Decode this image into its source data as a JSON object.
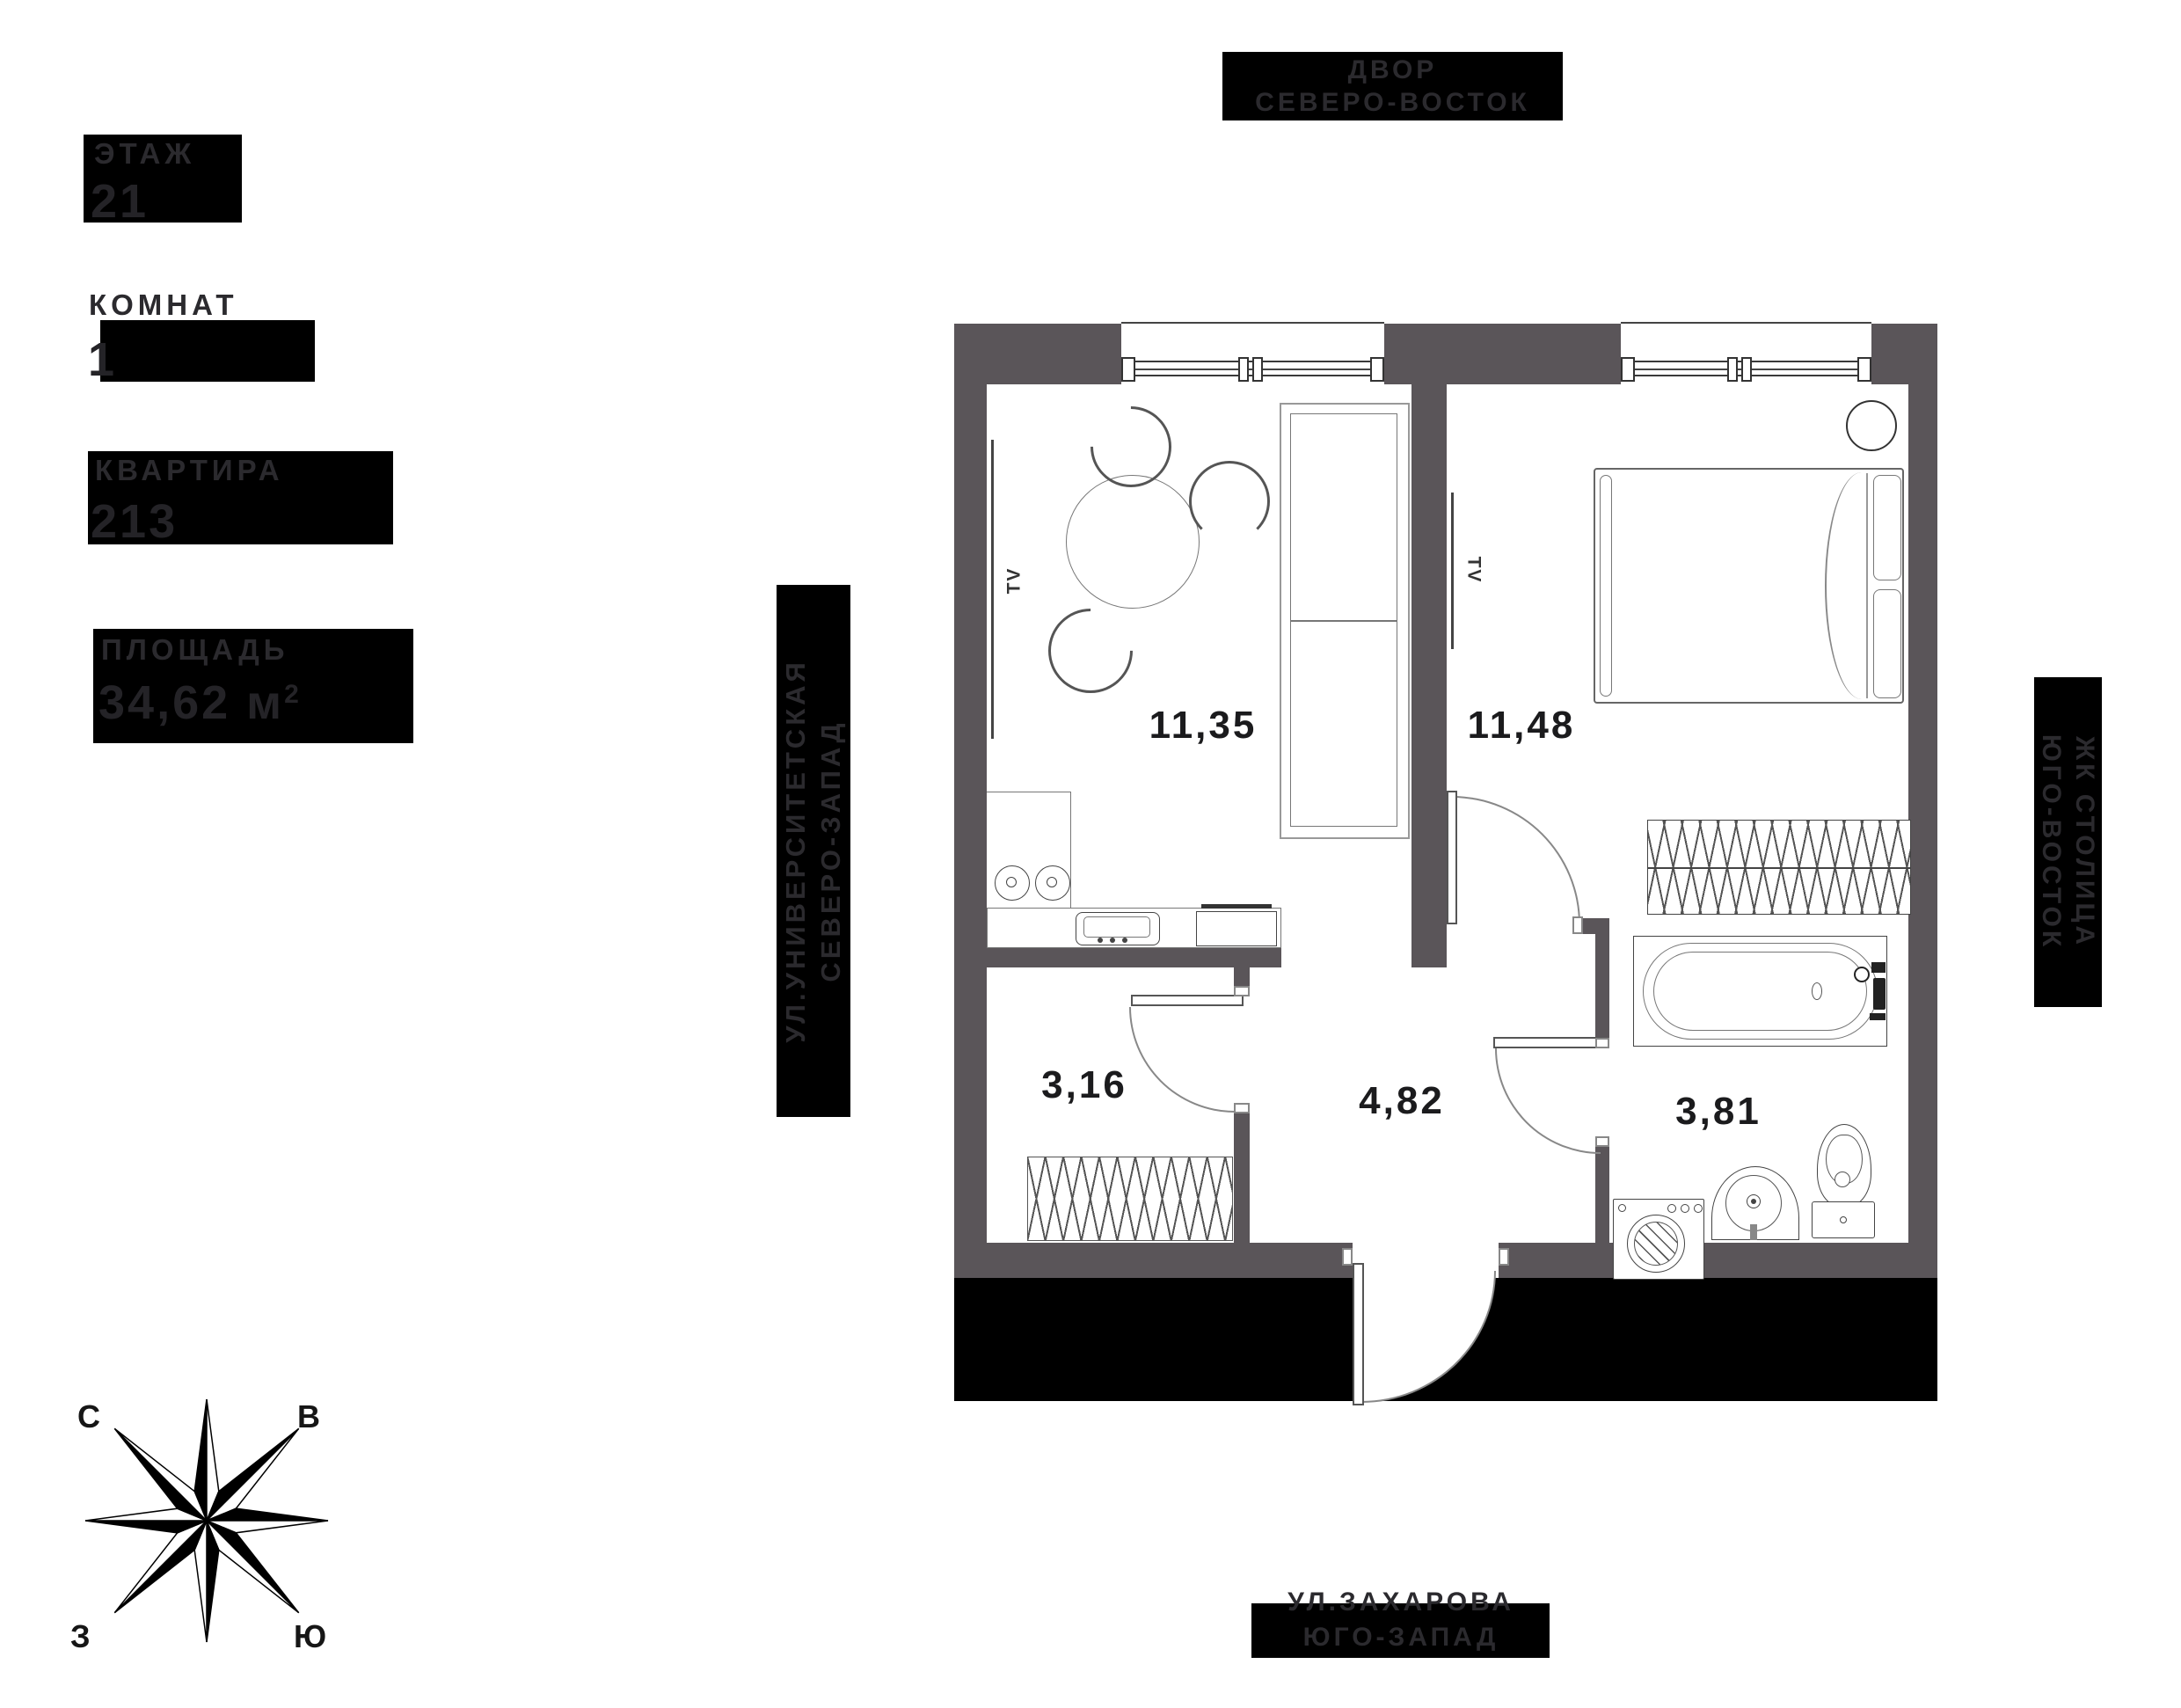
{
  "info_panel": {
    "floor_label": "ЭТАЖ",
    "floor_value": "21",
    "rooms_label": "КОМНАТ",
    "rooms_value": "1",
    "apartment_label": "КВАРТИРА",
    "apartment_value": "213",
    "area_label": "ПЛОЩАДЬ",
    "area_value": "34,62 м",
    "area_sup": "2"
  },
  "orientation_labels": {
    "top": {
      "line1": "ДВОР",
      "line2": "СЕВЕРО-ВОСТОК"
    },
    "left": {
      "line1": "УЛ.УНИВЕРСИТЕТСКАЯ",
      "line2": "СЕВЕРО-ЗАПАД"
    },
    "right": {
      "line1": "ЖК СТОЛИЦА",
      "line2": "ЮГО-ВОСТОК"
    },
    "bottom": {
      "line1": "УЛ.ЗАХАРОВА",
      "line2": "ЮГО-ЗАПАД"
    }
  },
  "compass": {
    "north": "С",
    "east": "В",
    "west": "З",
    "south": "Ю"
  },
  "rooms": [
    {
      "name": "kitchen-living",
      "area": "11,35"
    },
    {
      "name": "bedroom",
      "area": "11,48"
    },
    {
      "name": "closet",
      "area": "3,16"
    },
    {
      "name": "hallway",
      "area": "4,82"
    },
    {
      "name": "bathroom",
      "area": "3,81"
    }
  ],
  "furniture_labels": {
    "tv": "TV"
  },
  "colors": {
    "wall": "#5a5559",
    "black": "#000000",
    "label_text": "#2b2a2e",
    "room_number": "#1b1b1d",
    "furniture_line": "#666666"
  }
}
